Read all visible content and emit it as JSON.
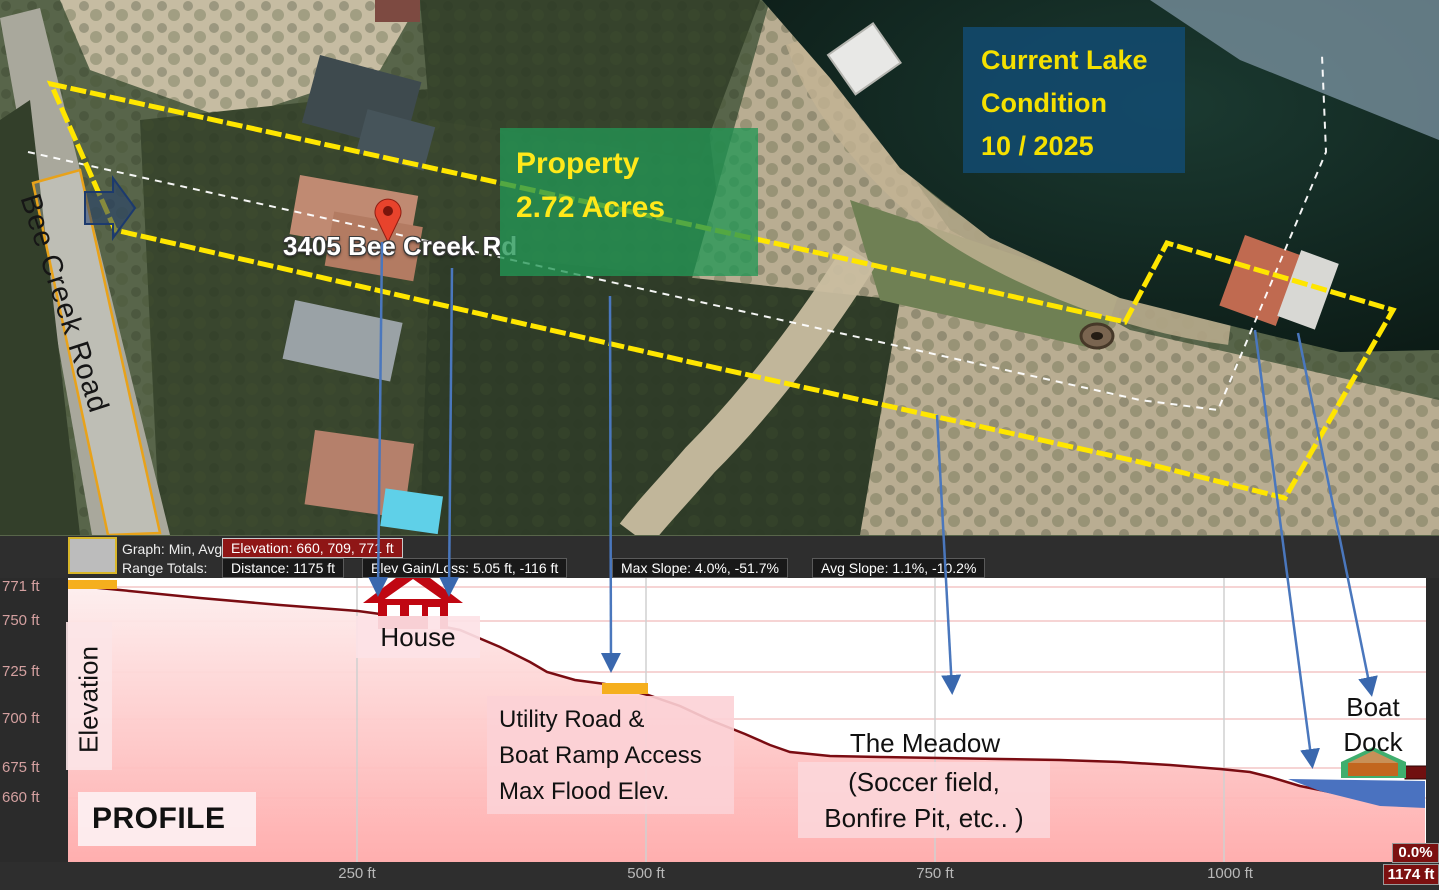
{
  "map": {
    "road_label": "Bee Creek Road",
    "address_label": "3405 Bee Creek Rd",
    "property_box": {
      "line1": "Property",
      "line2": "2.72 Acres"
    },
    "lake_box": {
      "line1": "Current Lake",
      "line2": "Condition",
      "line3": " 10 / 2025"
    }
  },
  "profile": {
    "stats": {
      "graph_label": "Graph: Min, Avg, Max",
      "elevation_stat": "Elevation: 660, 709, 771 ft",
      "range_totals_label": "Range Totals:",
      "distance_stat": "Distance: 1175 ft",
      "gain_loss_stat": "Elev Gain/Loss: 5.05 ft, -116 ft",
      "max_slope_stat": "Max Slope: 4.0%, -51.7%",
      "avg_slope_stat": "Avg Slope: 1.1%, -10.2%"
    },
    "y_axis": [
      "771 ft",
      "750 ft",
      "725 ft",
      "700 ft",
      "675 ft",
      "660 ft"
    ],
    "x_axis": [
      "250 ft",
      "500 ft",
      "750 ft",
      "1000 ft"
    ],
    "end_distance": "1174 ft",
    "slope_badge": "0.0%",
    "elevation_axis_label": "Elevation",
    "profile_label": "PROFILE",
    "annotations": {
      "house": "House",
      "utility": [
        "Utility Road &",
        "Boat Ramp Access",
        "Max Flood Elev."
      ],
      "meadow": [
        "The Meadow",
        "(Soccer field,",
        "Bonfire Pit, etc.. )"
      ],
      "boat_dock": [
        "Boat",
        "Dock"
      ]
    }
  },
  "colors": {
    "boundary_yellow": "#ffe600",
    "annotation_blue": "#3f6fb5",
    "profile_line": "#7a0c12",
    "profile_fill": "#ffb2b2",
    "marker_orange": "#f5af1e",
    "water_blue": "#4a72c0",
    "stat_red": "#8f1616",
    "property_green": "#22965a",
    "lake_navy": "#124a6e",
    "label_yellow": "#ffe81a"
  },
  "chart_data": {
    "type": "area",
    "title": "Elevation Profile",
    "ylabel": "Elevation",
    "xlim_ft": [
      0,
      1174
    ],
    "ylim_ft": [
      660,
      771
    ],
    "x_ticks": [
      "250 ft",
      "500 ft",
      "750 ft",
      "1000 ft",
      "1174 ft"
    ],
    "y_ticks": [
      "771 ft",
      "750 ft",
      "725 ft",
      "700 ft",
      "675 ft",
      "660 ft"
    ],
    "x_ft": [
      0,
      114,
      251,
      339,
      374,
      414,
      464,
      502,
      555,
      607,
      659,
      754,
      858,
      953,
      1022,
      1083,
      1152,
      1174
    ],
    "elevation_ft": [
      771,
      765,
      759,
      749,
      740,
      727,
      721,
      716,
      703,
      690,
      684,
      683,
      682,
      680,
      676,
      667,
      661,
      660
    ],
    "stats": {
      "elevation_min": 660,
      "elevation_avg": 709,
      "elevation_max": 771,
      "distance_ft": 1175,
      "elev_gain_ft": 5.05,
      "elev_loss_ft": -116,
      "max_slope_pct": 4.0,
      "min_slope_pct": -51.7,
      "avg_slope_up_pct": 1.1,
      "avg_slope_down_pct": -10.2
    },
    "annotations_at_ft": {
      "house": 300,
      "utility_road_max_flood": 470,
      "meadow": 770,
      "boat_dock": 1120,
      "water_level": 1060
    }
  }
}
